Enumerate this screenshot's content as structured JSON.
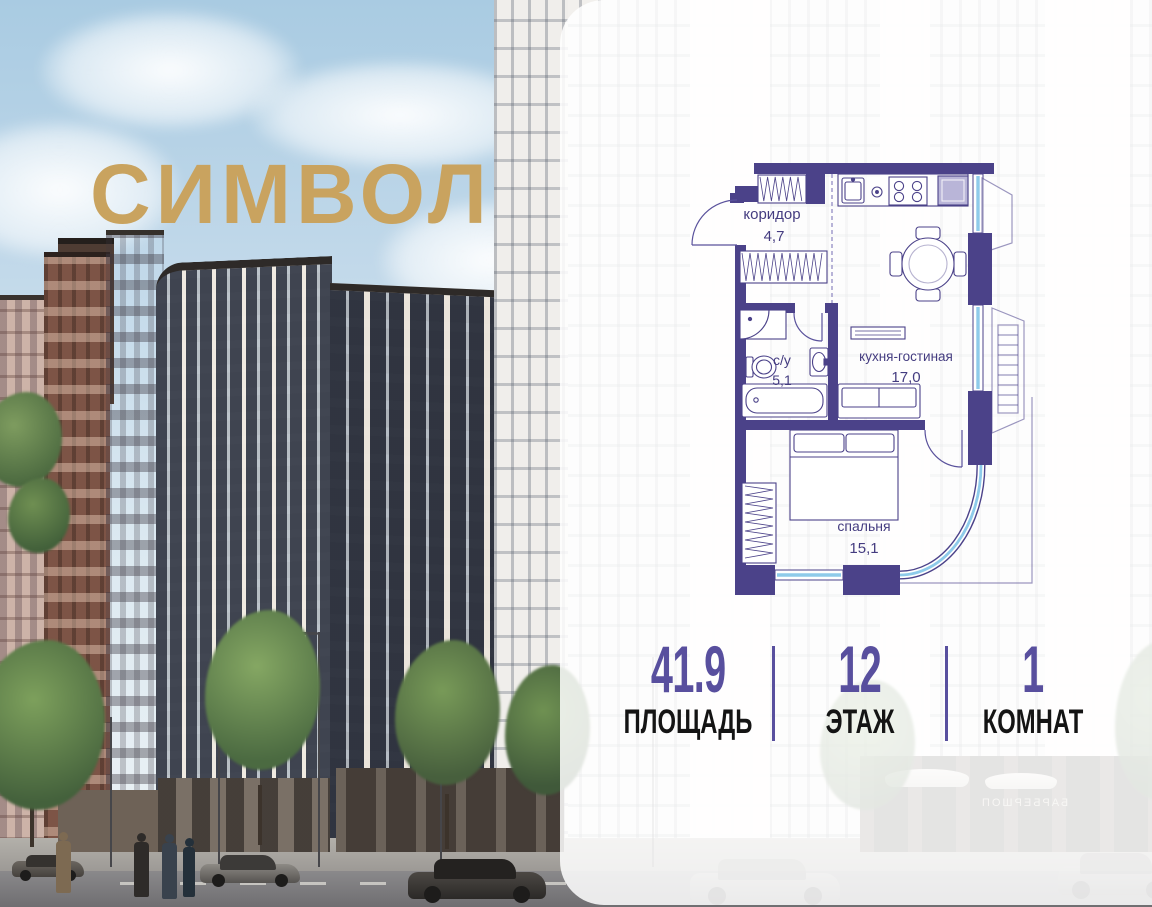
{
  "brand": {
    "logo_text": "СИМВОЛ",
    "logo_color": "#c9a35f"
  },
  "floorplan": {
    "wall_color": "#4b4289",
    "glass_color": "#8ecbea",
    "label_color": "#443c80",
    "rooms": [
      {
        "name": "коридор",
        "area": "4,7"
      },
      {
        "name": "с/у",
        "area": "5,1"
      },
      {
        "name": "кухня-гостиная",
        "area": "17,0"
      },
      {
        "name": "спальня",
        "area": "15,1"
      }
    ]
  },
  "stats": {
    "accent_color": "#584f9e",
    "items": [
      {
        "value": "41.9",
        "label": "ПЛОЩАДЬ"
      },
      {
        "value": "12",
        "label": "ЭТАЖ"
      },
      {
        "value": "1",
        "label": "КОМНАТ"
      }
    ]
  },
  "photo": {
    "signage_text": "БАРБЕРШОП"
  }
}
